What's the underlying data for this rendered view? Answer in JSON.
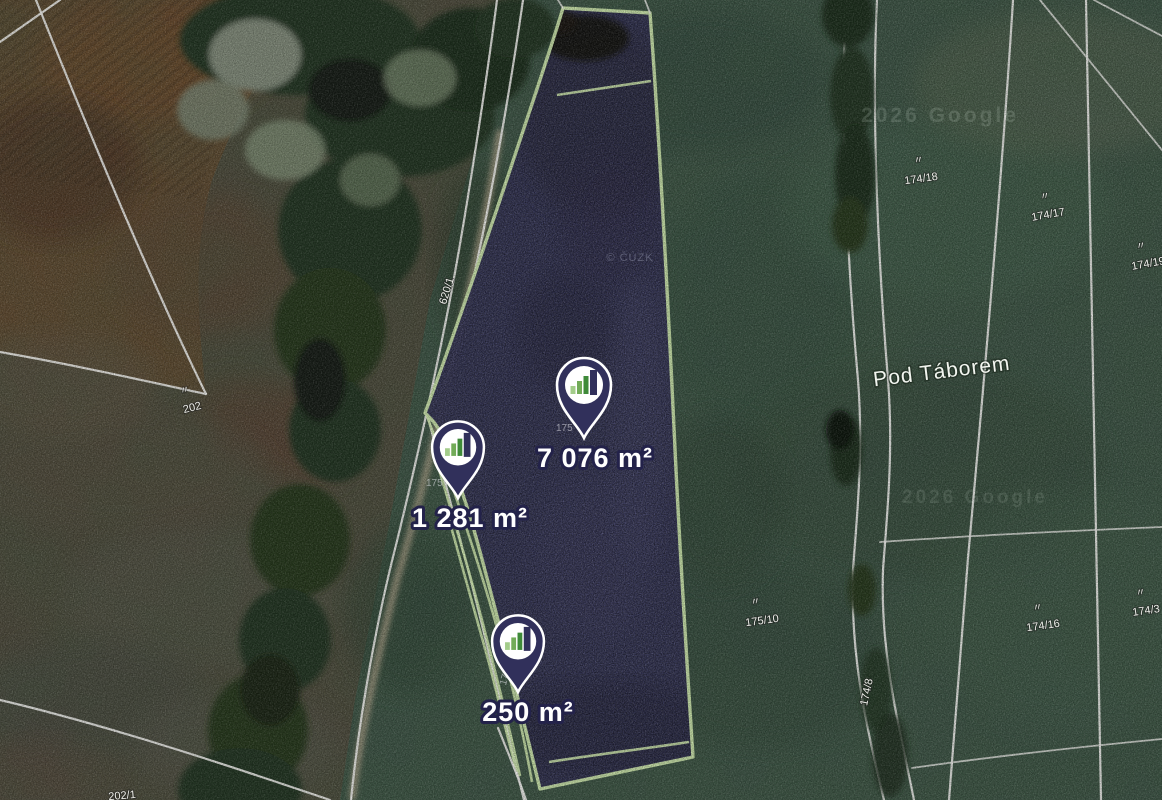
{
  "map": {
    "markers": [
      {
        "name": "marker-7076",
        "label": "7 076 m²"
      },
      {
        "name": "marker-1281",
        "label": "1 281 m²"
      },
      {
        "name": "marker-250",
        "label": "250 m²"
      }
    ],
    "place_label": "Pod Táborem",
    "ditto_mark": "〃",
    "parcel_numbers": {
      "n174_18": "174/18",
      "n174_17": "174/17",
      "n174_19": "174/19",
      "n175_10": "175/10",
      "n174_16": "174/16",
      "n174_3": "174/3",
      "n202": "202",
      "n202_1": "202/1",
      "n620_1": "620/1",
      "n174_8": "174/8",
      "occluded_a": "175",
      "occluded_b": "175",
      "occluded_c": "175"
    },
    "watermarks": {
      "top": "2026 Google",
      "center": "2026 Google",
      "imagery": "© ČÚZK"
    },
    "colors": {
      "parcel_fill": "#403f66",
      "parcel_border": "#cfe9ad",
      "pin": "#31305b",
      "boundary_line": "#f1f1ee",
      "label_text": "#ffffff",
      "label_outline": "#23224a"
    }
  }
}
